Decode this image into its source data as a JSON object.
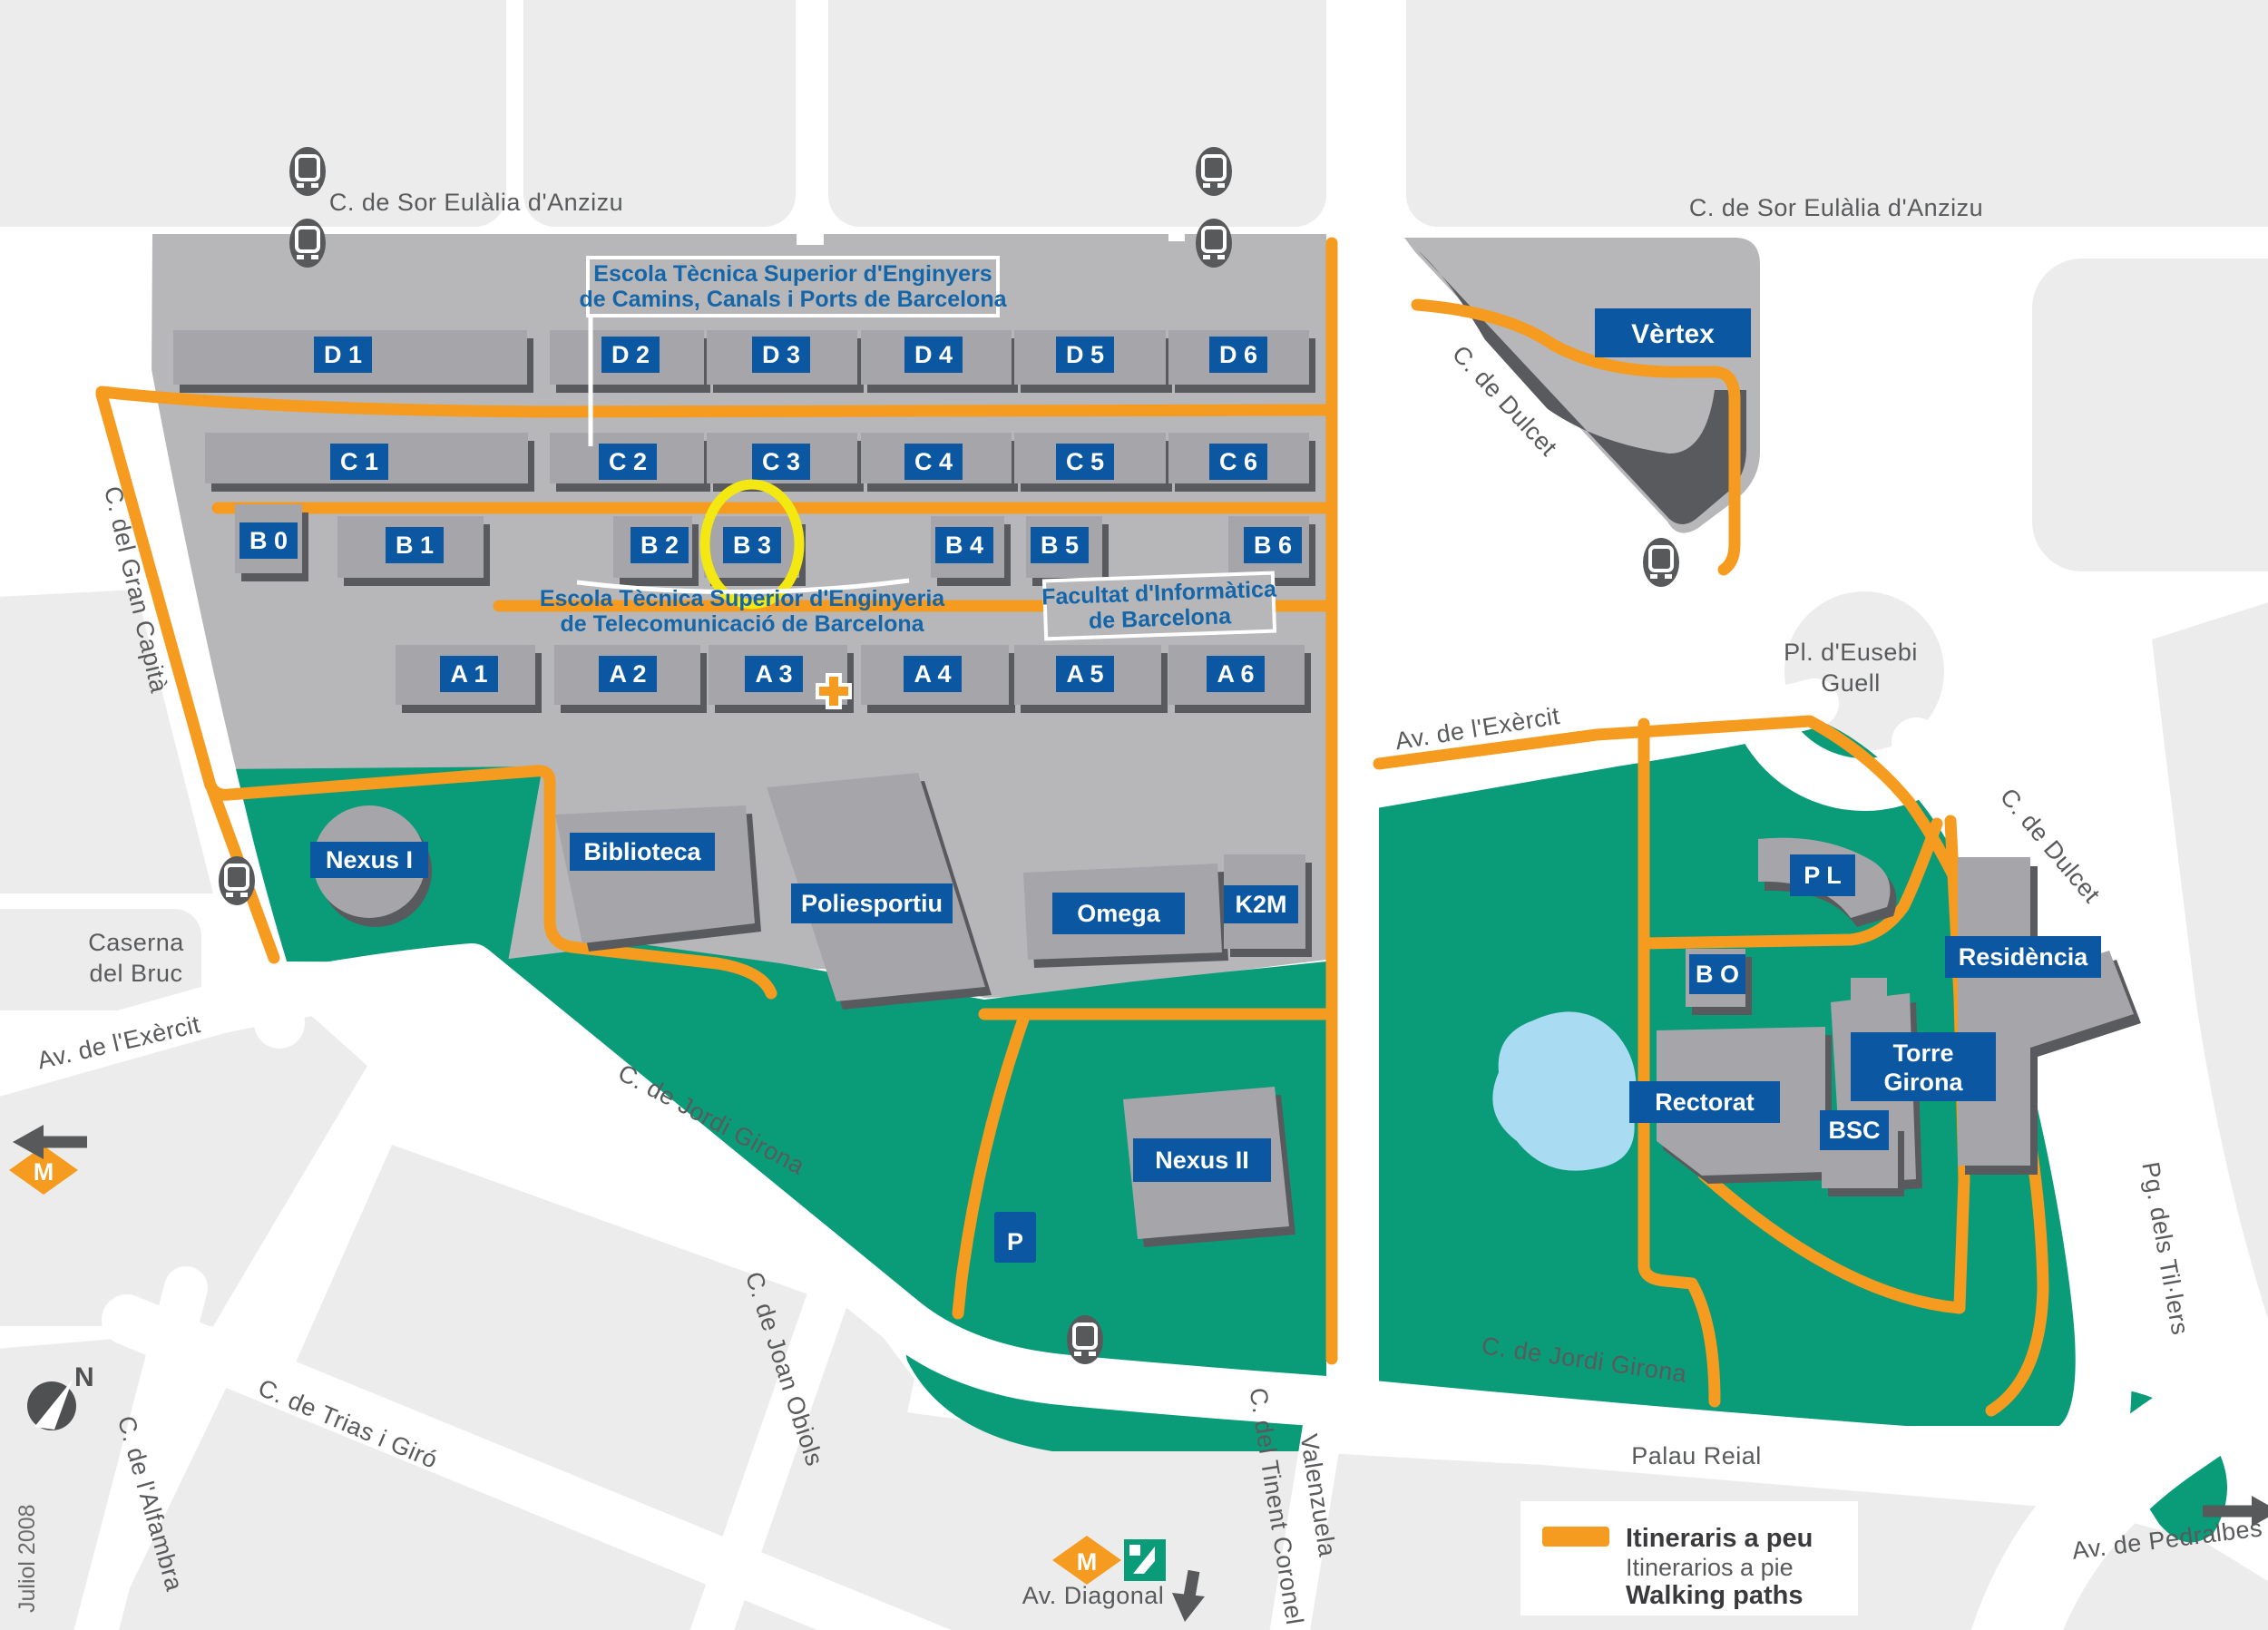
{
  "streets": {
    "sor_eulalia": "C. de Sor Eulàlia d'Anzizu",
    "gran_capita": "C. del Gran Capità",
    "dulcet": "C. de Dulcet",
    "exercit": "Av. de l'Exèrcit",
    "jordi_girona": "C. de Jordi Girona",
    "joan_obiols": "C. de Joan Obiols",
    "trias_giro": "C. de Trias i Giró",
    "alfambra": "C. de l'Alfambra",
    "tinent_l1": "C. del Tinent Coronel",
    "tinent_l2": "Valenzuela",
    "tillers": "Pg. dels Til·lers",
    "diagonal": "Av. Diagonal",
    "pedralbes": "Av. de Pedralbes"
  },
  "places": {
    "caserna_l1": "Caserna",
    "caserna_l2": "del Bruc",
    "eusebi_l1": "Pl. d'Eusebi",
    "eusebi_l2": "Guell",
    "palau": "Palau Reial"
  },
  "schools": {
    "camins_l1": "Escola Tècnica Superior d'Enginyers",
    "camins_l2": "de Camins, Canals i Ports de Barcelona",
    "telecom_l1": "Escola Tècnica Superior d'Enginyeria",
    "telecom_l2": "de Telecomunicació de Barcelona",
    "fib_l1": "Facultat d'Informàtica",
    "fib_l2": "de Barcelona"
  },
  "buildings": {
    "d": [
      "D 1",
      "D 2",
      "D 3",
      "D 4",
      "D 5",
      "D 6"
    ],
    "c": [
      "C 1",
      "C 2",
      "C 3",
      "C 4",
      "C 5",
      "C 6"
    ],
    "b": [
      "B 0",
      "B 1",
      "B 2",
      "B 3",
      "B 4",
      "B 5",
      "B 6"
    ],
    "a": [
      "A 1",
      "A 2",
      "A 3",
      "A 4",
      "A 5",
      "A 6"
    ],
    "named": {
      "vertex": "Vèrtex",
      "nexus1": "Nexus I",
      "biblioteca": "Biblioteca",
      "poliesportiu": "Poliesportiu",
      "omega": "Omega",
      "k2m": "K2M",
      "nexus2": "Nexus II",
      "pl": "P L",
      "bo": "B O",
      "residencia": "Residència",
      "torre_l1": "Torre",
      "torre_l2": "Girona",
      "rectorat": "Rectorat",
      "bsc": "BSC"
    }
  },
  "legend": {
    "line1": "Itineraris a peu",
    "line2": "Itinerarios a pie",
    "line3": "Walking paths"
  },
  "misc": {
    "date": "Juliol 2008",
    "north": "N",
    "parking": "P",
    "metro_m": "M"
  },
  "colors": {
    "green": "#0A9B78",
    "orange_path": "#F59B20",
    "chip_blue": "#0B57A2",
    "school_blue": "#1566A9",
    "campus_gray": "#B7B7BA",
    "building_gray": "#A6A6AA",
    "block_gray": "#ECECEC",
    "lake_blue": "#A9DCF3",
    "highlight_yellow": "#F3E812"
  }
}
